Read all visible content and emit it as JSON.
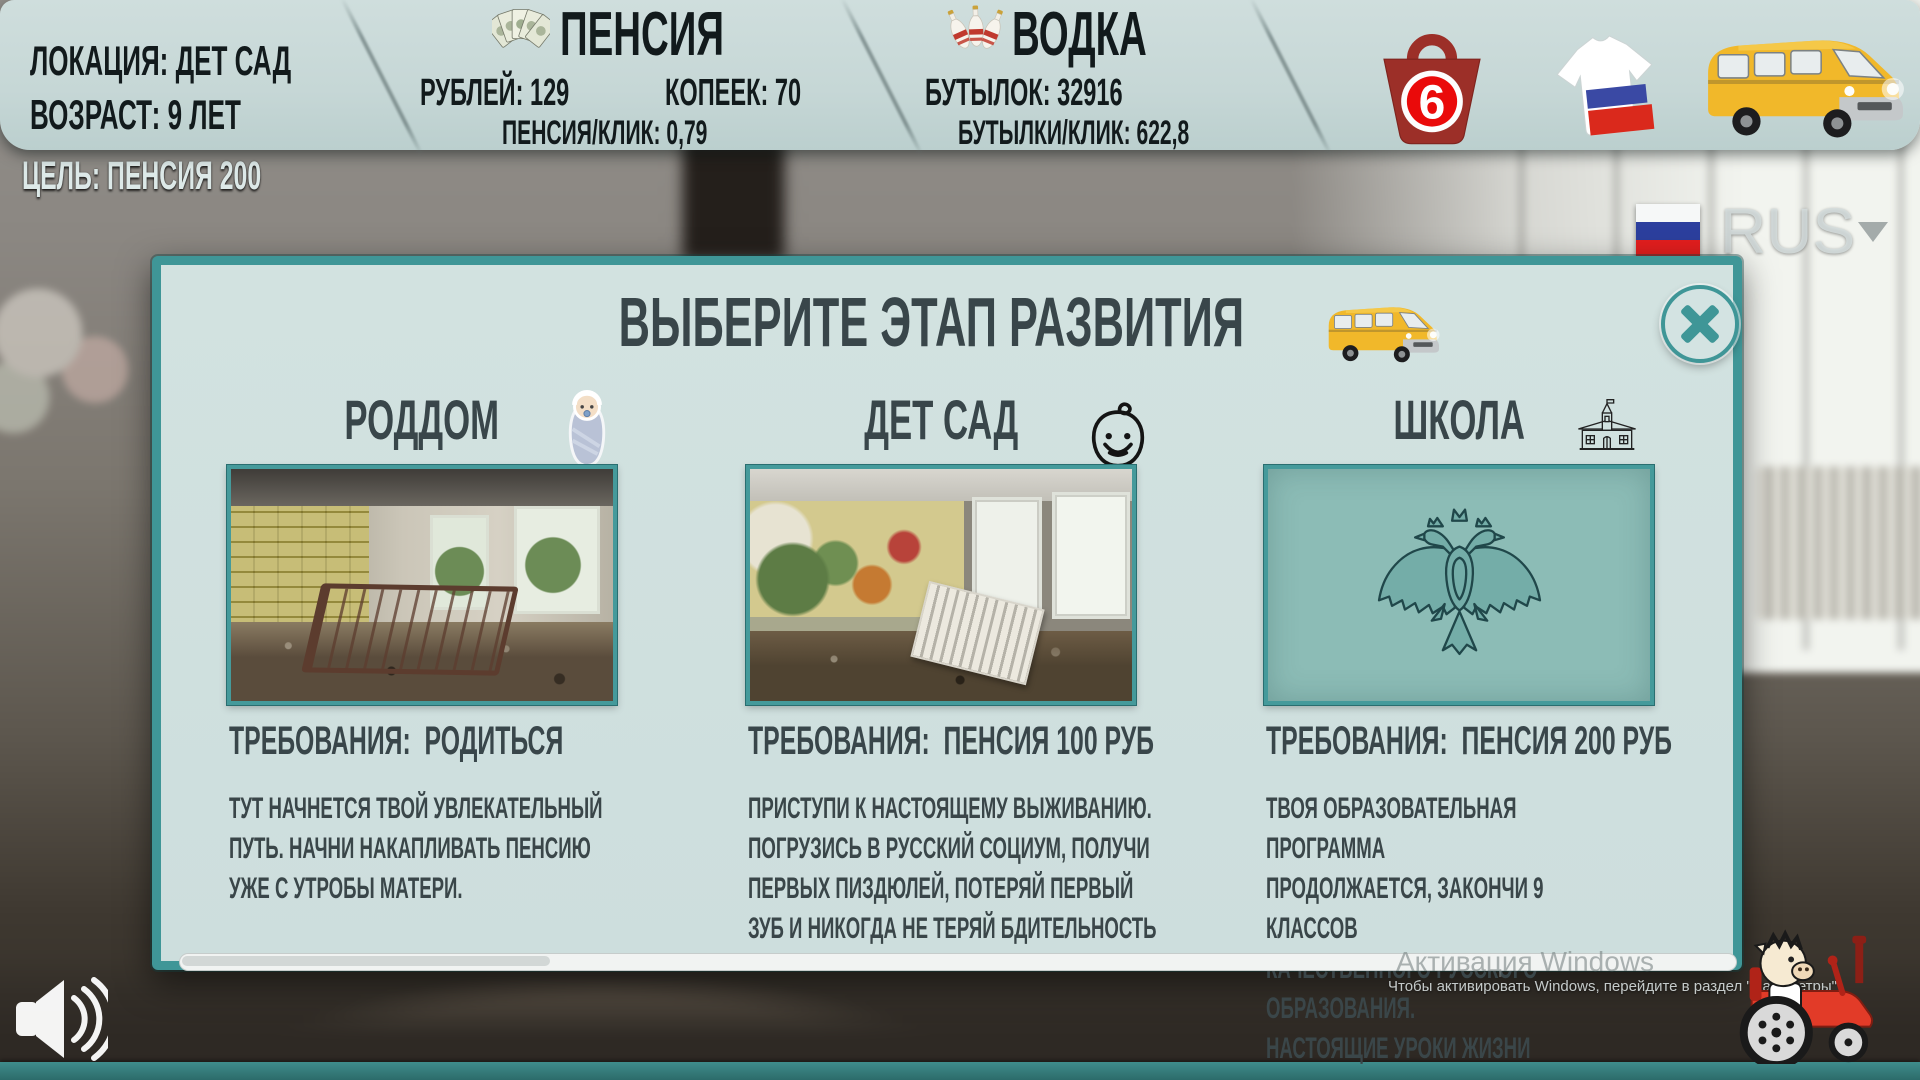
{
  "header": {
    "location_line1": "ЛОКАЦИЯ: ДЕТ САД",
    "location_line2": "ВОЗРАСТ: 9 ЛЕТ",
    "pension": {
      "title": "ПЕНСИЯ",
      "rubles_label": "РУБЛЕЙ: 129",
      "kopecks_label": "КОПЕЕК: 70",
      "per_click_label": "ПЕНСИЯ/КЛИК: 0,79",
      "icon": "money-fan-icon"
    },
    "vodka": {
      "title": "ВОДКА",
      "bottles_label": "БУТЫЛОК: 32916",
      "per_click_label": "БУТЫЛКИ/КЛИК: 622,8",
      "icon": "vodka-bottles-icon"
    },
    "shop_bag_number": "6",
    "buttons": [
      "shop-bag-icon",
      "tshirt-flag-icon",
      "van-icon"
    ]
  },
  "goal_label": "ЦЕЛЬ: ПЕНСИЯ 200",
  "language_selector": {
    "code": "RUS",
    "flag": "flag-russia",
    "dropdown_arrow": "▼"
  },
  "dialog": {
    "title": "ВЫБЕРИТЕ ЭТАП РАЗВИТИЯ",
    "title_icon": "van-icon",
    "close_icon": "x-cross",
    "stages": [
      {
        "name": "РОДДОМ",
        "icon": "swaddled-baby-icon",
        "image": "abandoned-maternity-ward-photo",
        "requirement": "ТРЕБОВАНИЯ:  РОДИТЬСЯ",
        "description": "ТУТ НАЧНЕТСЯ ТВОЙ УВЛЕКАТЕЛЬНЫЙ\nПУТЬ. НАЧНИ НАКАПЛИВАТЬ ПЕНСИЮ\nУЖЕ С УТРОБЫ МАТЕРИ."
      },
      {
        "name": "ДЕТ САД",
        "icon": "child-face-icon",
        "image": "abandoned-kindergarten-photo",
        "requirement": "ТРЕБОВАНИЯ:  ПЕНСИЯ 100 РУБ",
        "description": "ПРИСТУПИ К НАСТОЯЩЕМУ ВЫЖИВАНИЮ.\nПОГРУЗИСЬ В РУССКИЙ СОЦИУМ, ПОЛУЧИ\nПЕРВЫХ ПИЗДЮЛЕЙ, ПОТЕРЯЙ ПЕРВЫЙ\nЗУБ И НИКОГДА НЕ ТЕРЯЙ БДИТЕЛЬНОСТЬ"
      },
      {
        "name": "ШКОЛА",
        "icon": "school-building-icon",
        "image": "russian-coat-of-arms-emblem",
        "requirement": "ТРЕБОВАНИЯ:  ПЕНСИЯ 200 РУБ",
        "description": "ТВОЯ ОБРАЗОВАТЕЛЬНАЯ ПРОГРАММА\nПРОДОЛЖАЕТСЯ, ЗАКОНЧИ 9 КЛАССОВ\nКАЧЕСТВЕННОГО РУССКОГО ОБРАЗОВАНИЯ.\nНАСТОЯЩИЕ УРОКИ ЖИЗНИ"
      }
    ]
  },
  "watermark": {
    "line1": "Активация Windows",
    "line2": "Чтобы активировать Windows, перейдите в раздел \"Параметры\""
  },
  "footer_icons": {
    "sound": "speaker-icon",
    "mascot": "pig-on-tractor-icon"
  },
  "colors": {
    "accent_teal": "#3f9697",
    "panel": "#c6d7d6",
    "dialog_bg": "#cfe0de",
    "bag_red": "#9c2f28",
    "badge_red": "#ea0a0a",
    "flag_white": "#f6f8f8",
    "flag_blue": "#2c3f9e",
    "flag_red": "#e31e1e",
    "van_yellow": "#f1b82a",
    "emblem_teal": "#74ada8",
    "text_dark": "#121a1c"
  }
}
